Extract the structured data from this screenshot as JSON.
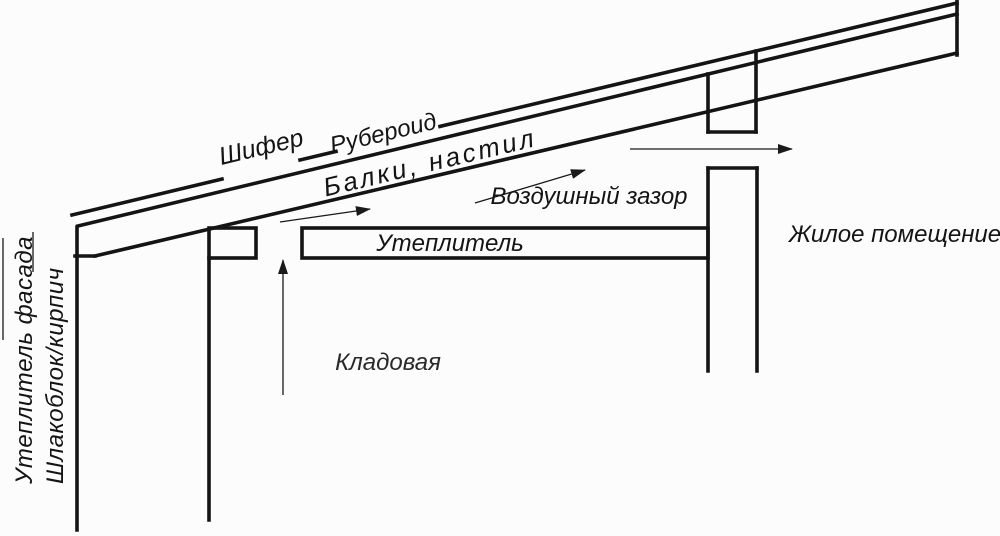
{
  "diagram": {
    "description": "Roof and attic insulation construction scheme (cross-section)",
    "colors": {
      "background": "#fcfcfc",
      "line": "#141414"
    },
    "labels": {
      "roofing_slate": "Шифер",
      "roofing_felt": "Рубероид",
      "beams_decking": "Балки, настил",
      "air_gap": "Воздушный зазор",
      "insulation": "Утеплитель",
      "living_space": "Жилое помещение",
      "storage_room": "Кладовая",
      "facade_insulation": "Утеплитель фасада",
      "wall_material": "Шлакоблок/кирпич"
    },
    "icons": {
      "airflow_arrows": "arrow-right-icon, arrow-up-icon (air circulation direction)"
    }
  }
}
